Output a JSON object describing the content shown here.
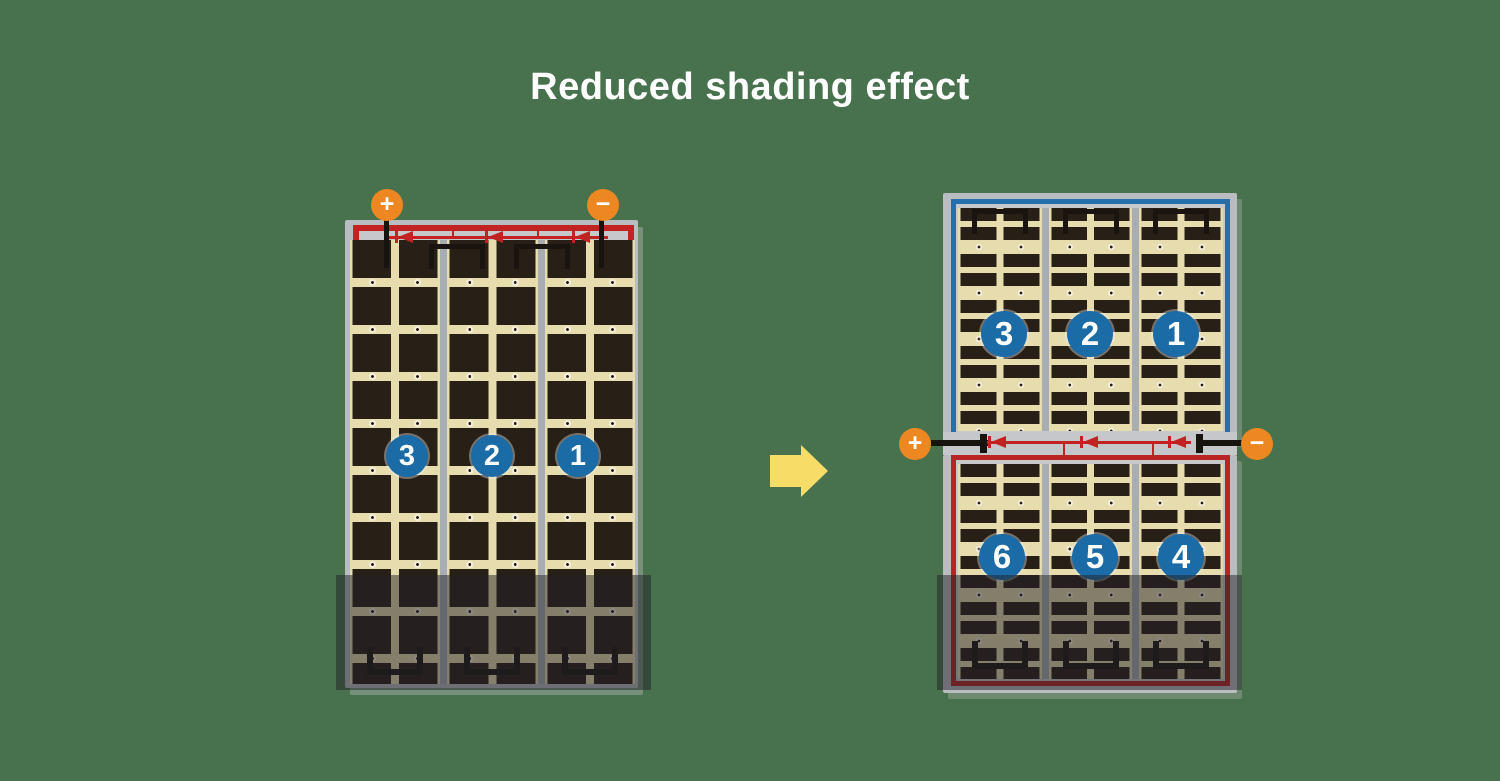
{
  "title": "Reduced shading effect",
  "colors": {
    "background": "#48714d",
    "panel_frame": "#b9bcc0",
    "cell_field": "#e6dcad",
    "cell_dark": "#281f16",
    "red_circuit": "#c32222",
    "blue_circuit": "#2470ae",
    "terminal_orange": "#ed8722",
    "string_badge_blue": "#1b6ba6",
    "arrow_yellow": "#f8dc68"
  },
  "left_panel": {
    "type": "full-cell module",
    "terminal_positive": "+",
    "terminal_negative": "−",
    "diode_count": 3,
    "strings": [
      {
        "label": "3"
      },
      {
        "label": "2"
      },
      {
        "label": "1"
      }
    ]
  },
  "right_panel": {
    "type": "half-cut module",
    "terminal_positive": "+",
    "terminal_negative": "−",
    "diode_count": 3,
    "top_strings": [
      {
        "label": "3"
      },
      {
        "label": "2"
      },
      {
        "label": "1"
      }
    ],
    "bottom_strings": [
      {
        "label": "6"
      },
      {
        "label": "5"
      },
      {
        "label": "4"
      }
    ]
  }
}
